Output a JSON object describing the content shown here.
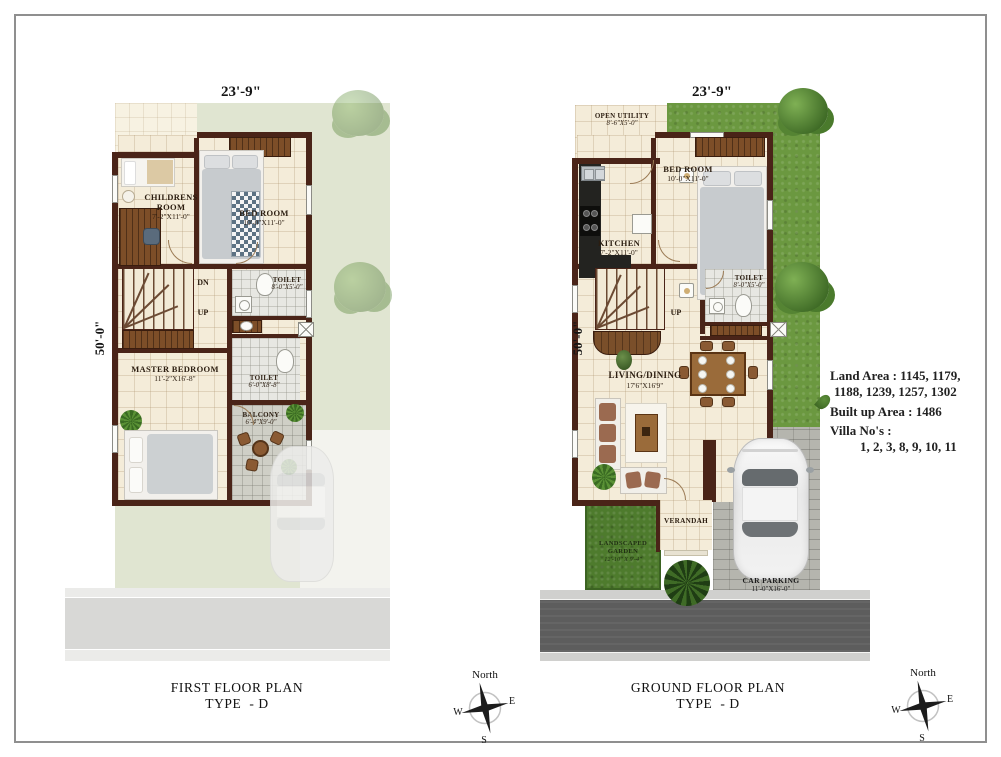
{
  "first_floor": {
    "top_dim": "23'-9\"",
    "side_dim": "50'-0\"",
    "caption": {
      "title": "FIRST FLOOR PLAN",
      "type": "TYPE  - D"
    },
    "stairs": {
      "dn": "DN",
      "up": "UP"
    },
    "rooms": {
      "childrens_room": {
        "label": "CHILDRENS ROOM",
        "dims": "7'-2\"X11'-0\""
      },
      "bed_room": {
        "label": "BED ROOM",
        "dims": "10'-0\"X11'-0\""
      },
      "toilet_upper": {
        "label": "TOILET",
        "dims": "8'-0\"X5'-0\""
      },
      "toilet_lower": {
        "label": "TOILET",
        "dims": "6'-0\"X8'-8\""
      },
      "master_bedroom": {
        "label": "MASTER BEDROOM",
        "dims": "11'-2\"X16'-8\""
      },
      "balcony": {
        "label": "BALCONY",
        "dims": "6'-4\"X9'-0\""
      }
    }
  },
  "ground_floor": {
    "top_dim": "23'-9\"",
    "side_dim": "50'-0\"",
    "caption": {
      "title": "GROUND FLOOR PLAN",
      "type": "TYPE  - D"
    },
    "stairs": {
      "up": "UP"
    },
    "rooms": {
      "open_utility": {
        "label": "OPEN UTILITY",
        "dims": "8'-6\"X5'-0\""
      },
      "kitchen": {
        "label": "KITCHEN",
        "dims": "7'-2\"X11'-0\""
      },
      "bed_room": {
        "label": "BED ROOM",
        "dims": "10'-0\"X11'-0\""
      },
      "toilet": {
        "label": "TOILET",
        "dims": "8'-0\"X5'-0\""
      },
      "living_dining": {
        "label": "LIVING/DINING",
        "dims": "17'6\"X16'9\""
      },
      "verandah": {
        "label": "VERANDAH"
      },
      "landscaped_garden": {
        "label": "LANDSCAPED GARDEN",
        "dims": "12'-10\" X 9'-4\""
      },
      "car_parking": {
        "label": "CAR PARKING",
        "dims": "11'-0\"X16'-0\""
      }
    }
  },
  "info_block": {
    "land_area_line1": "Land Area : 1145, 1179,",
    "land_area_line2": "1188, 1239, 1257, 1302",
    "built_up_area": "Built up Area : 1486",
    "villa_label": "Villa No's :",
    "villa_numbers": "1, 2, 3, 8, 9, 10, 11"
  },
  "compass": {
    "north": "North",
    "east": "E",
    "west": "W",
    "south": "S"
  },
  "colors": {
    "wall": "#4a2418",
    "floor": "#f4ecd9",
    "grass": "#6b9840",
    "garden": "#4e7b2d",
    "pale_green": "#e0e5d1",
    "road": "#5d5d5d",
    "wood": "#7d4e28"
  }
}
